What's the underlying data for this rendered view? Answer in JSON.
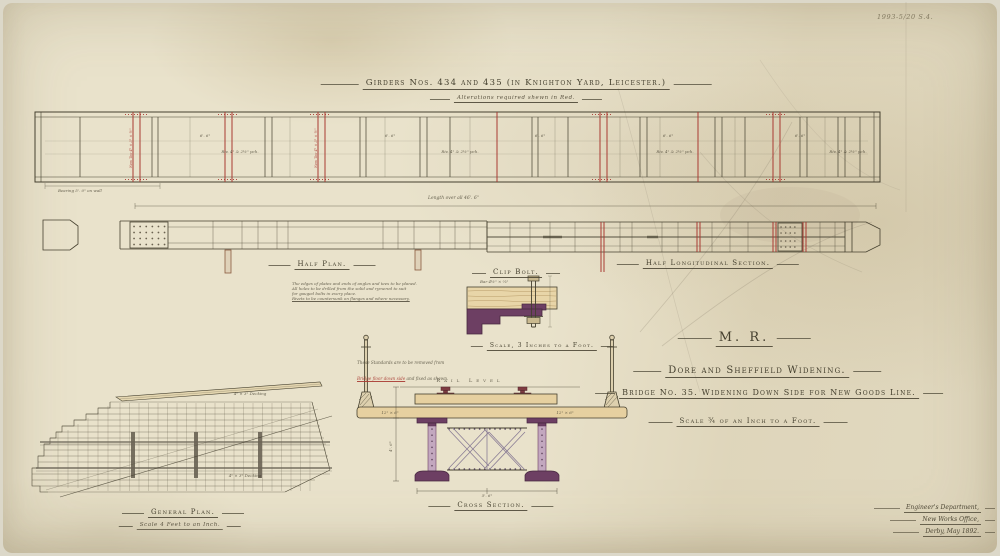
{
  "meta": {
    "ref_number": "1993-5/20 S.4."
  },
  "title": {
    "main": "Girders Nos. 434 and 435 (in Knighton Yard, Leicester.)",
    "sub": "Alterations required shewn in Red."
  },
  "labels": {
    "half_plan": "Half Plan.",
    "half_longitudinal_section": "Half Longitudinal Section.",
    "clip_bolt": "Clip Bolt.",
    "clip_bolt_scale": "Scale, 3 Inches to a Foot.",
    "cross_section": "Cross Section.",
    "general_plan": "General Plan.",
    "general_plan_scale": "Scale 4 Feet to an Inch."
  },
  "title_block": {
    "company": "M. R.",
    "project": "Dore and Sheffield Widening.",
    "drawing": "Bridge No. 35. Widening Down Side for New Goods Line.",
    "scale": "Scale ¾ of an Inch to a Foot."
  },
  "imprint": {
    "department": "Engineer's Department,",
    "office": "New Works Office,",
    "place_date": "Derby, May 1892."
  },
  "notes": {
    "plate_note_1": "The edges of plates and ends of angles and tees to be planed.",
    "plate_note_2": "All holes to be drilled from the solid and rymered to suit",
    "plate_note_3": "for gauged bolts in every place.",
    "plate_note_4": "Rivets to be countersunk on flanges and where necessary.",
    "standards_note_1": "These Standards are to be removed from",
    "standards_note_2_red": "Bridge floor down side",
    "standards_note_2b": " and fixed as shewn.",
    "rail_level": "Rail Level",
    "length_overall": "Length over all 46'. 6\"",
    "bearing_note": "Bearing 5'. 0\" on wall",
    "panel_dim": "6'. 6\"",
    "rivet_pitch": "Riv. 4\" & 2½\" pch.",
    "new_tee": "New Tee 4\" × 3\" × ½\"",
    "clip_bar": "Bar 4½\" × ⅝\"",
    "baulk": "12\" × 6\"",
    "decking": "4\" × 3\" Decking",
    "cross_dim_width": "5'. 6\"",
    "cross_dim_height": "4'. 6\""
  },
  "colors": {
    "ink": "#45402f",
    "alteration_red": "#a93a32",
    "girder_purple": "#6d3f63",
    "timber": "#e6d0a0",
    "paper": "#e9e2cb"
  }
}
